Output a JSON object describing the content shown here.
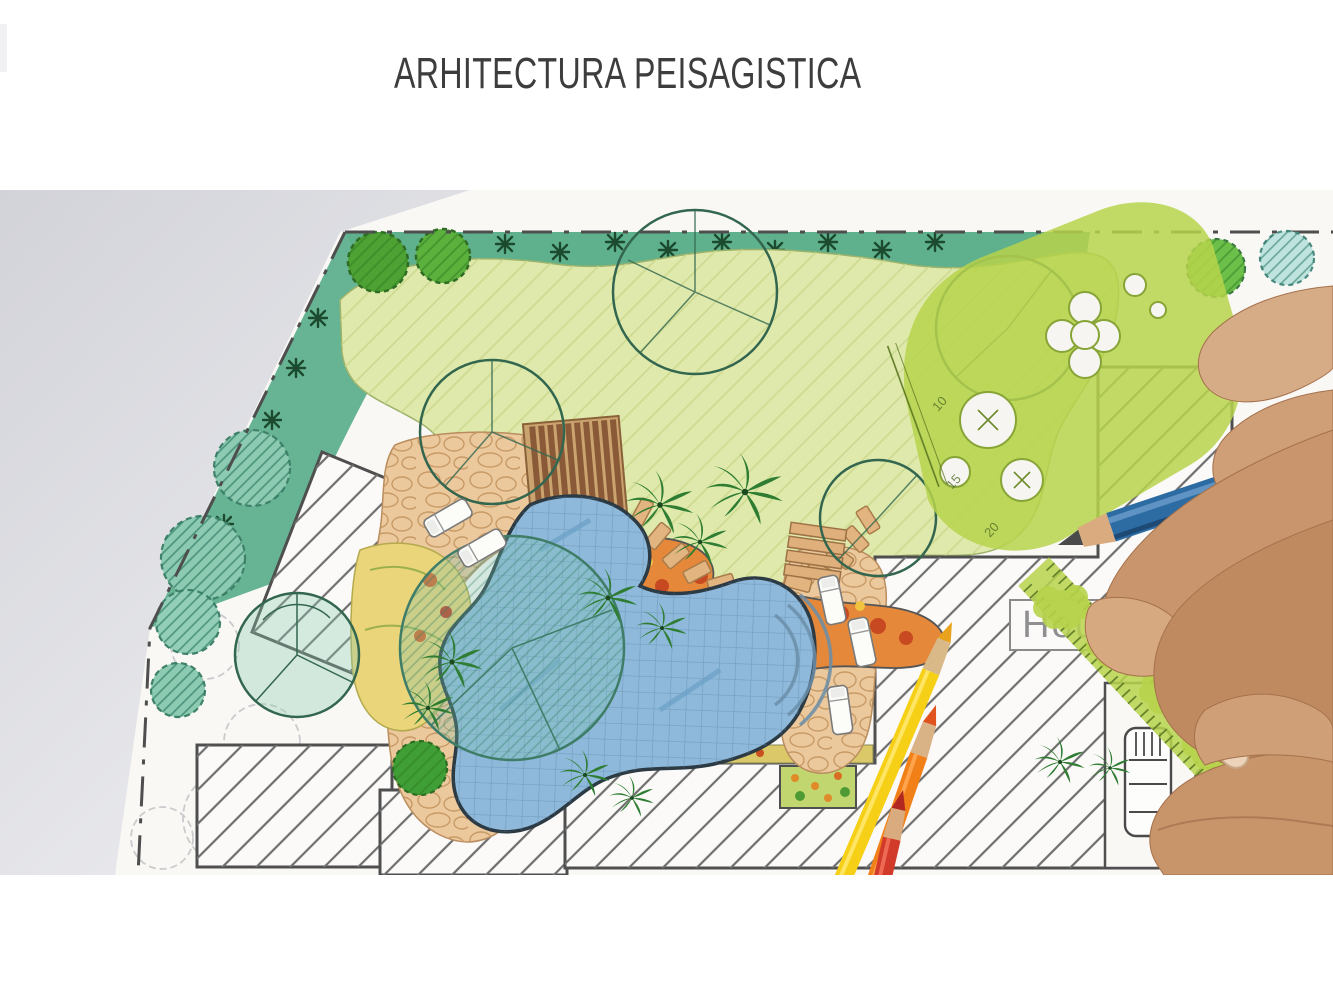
{
  "header": {
    "title": "ARHITECTURA PEISAGISTICA",
    "color": "#3d3d3d"
  },
  "photo": {
    "description": "Hand-drawn landscape architecture garden plan with lawn, pool, hatched house footprints, green drafting stencil and ruler, colored pencils and a hand drawing with a blue pencil",
    "plan": {
      "house_label": "House"
    },
    "tools": {
      "stencil_numbers": [
        "10",
        "15",
        "20"
      ],
      "pencil_colors": {
        "red": "#d23b2a",
        "orange": "#f28019",
        "yellow": "#f6cf17",
        "blue": "#2d6ba3"
      }
    },
    "palette": {
      "desk": "#d5d6db",
      "paper": "#f9f8f5",
      "lawn": "#dfe9ab",
      "border_planting": "#5fb08d",
      "pool": "#8fb9da",
      "stone": "#ecc89d",
      "stencil": "#b7d34b",
      "hatch": "#707070",
      "skin": "#c08d63"
    }
  }
}
